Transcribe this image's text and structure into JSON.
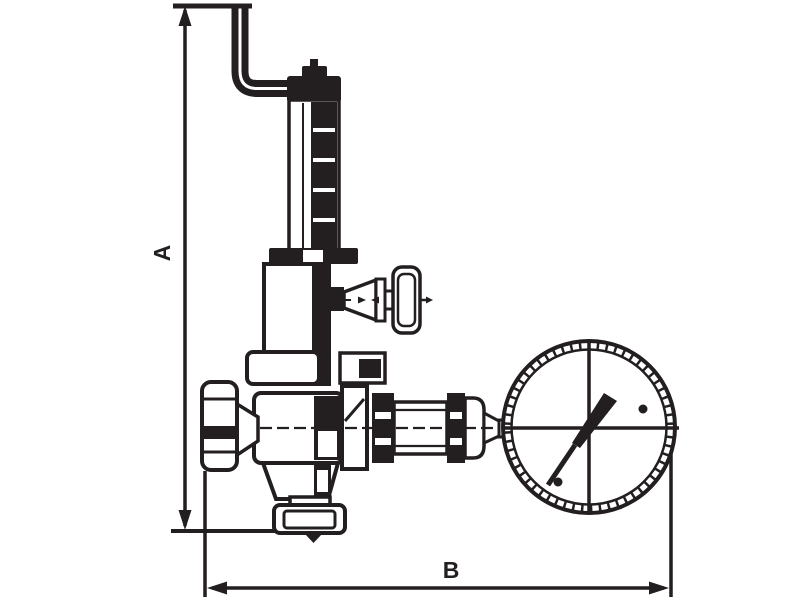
{
  "diagram": {
    "type": "technical-line-drawing",
    "subject": "safety relief valve with pressure gauge, dimensional outline drawing",
    "background_color": "#ffffff",
    "line_color": "#231f20",
    "dimensions": {
      "height_label": "A",
      "width_label": "B"
    },
    "components": [
      "relief-outlet-pipe",
      "spring-adjuster-cap",
      "spring-housing",
      "bonnet-flange",
      "valve-bonnet",
      "test-valve-handle",
      "mid-collar",
      "valve-body",
      "handwheel",
      "outlet-funnel",
      "bottom-flange",
      "gauge-connection",
      "pressure-gauge"
    ]
  }
}
